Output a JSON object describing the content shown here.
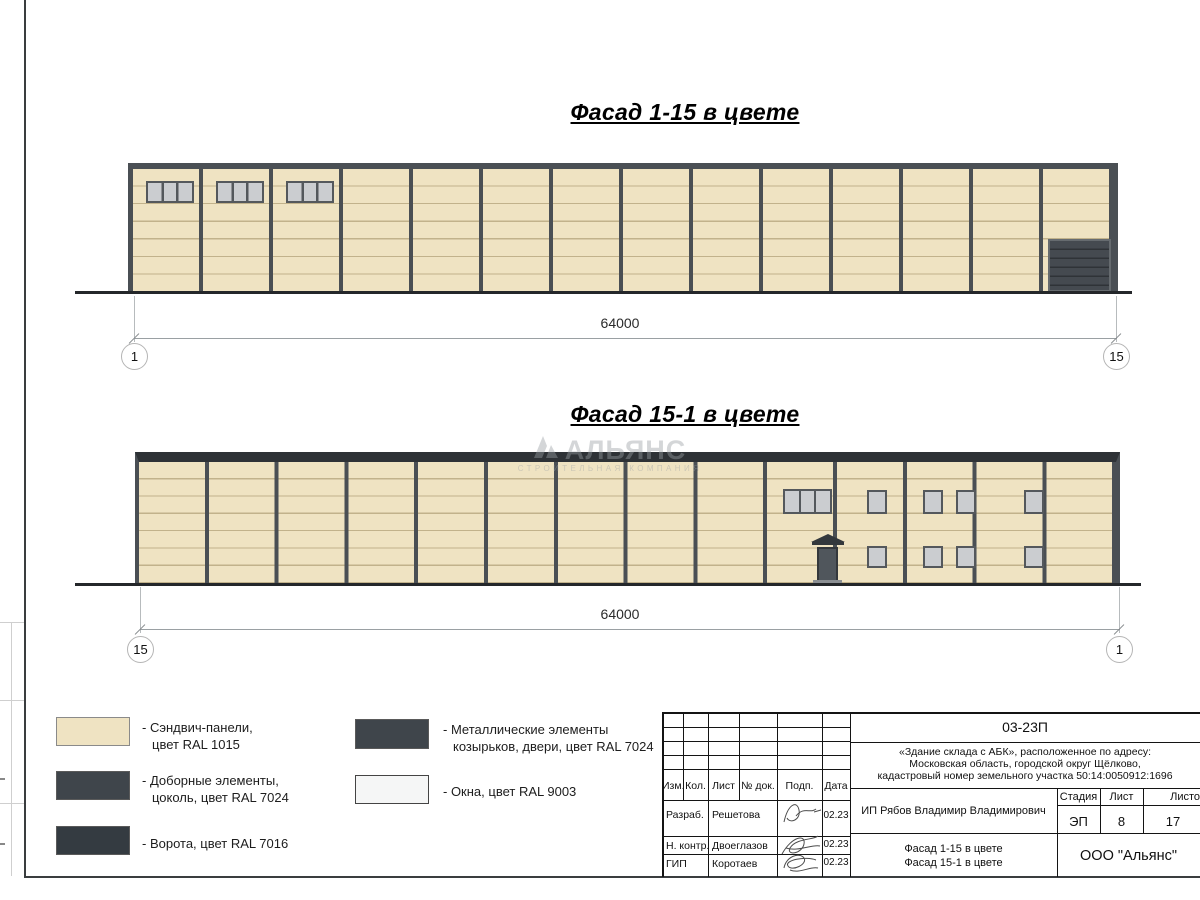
{
  "sheet": {
    "facade1": {
      "title": "Фасад 1-15 в цвете",
      "dim_total": "64000",
      "axis_left": "1",
      "axis_right": "15"
    },
    "facade2": {
      "title": "Фасад 15-1 в цвете",
      "dim_total": "64000",
      "axis_left": "15",
      "axis_right": "1"
    }
  },
  "watermark": {
    "brand": "АЛЬЯНС",
    "tagline": "СТРОИТЕЛЬНАЯ КОМПАНИЯ"
  },
  "legend": {
    "items": [
      {
        "swatch": "ral1015",
        "line1": "- Сэндвич-панели,",
        "line2": "цвет RAL 1015"
      },
      {
        "swatch": "ral7024",
        "line1": "- Доборные элементы,",
        "line2": "цоколь, цвет RAL 7024"
      },
      {
        "swatch": "ral7016",
        "line1": "- Ворота, цвет RAL 7016",
        "line2": ""
      },
      {
        "swatch": "ral7024",
        "line1": "- Металлические элементы",
        "line2": "козырьков, двери, цвет RAL 7024"
      },
      {
        "swatch": "ral9003",
        "line1": "- Окна, цвет RAL 9003",
        "line2": ""
      }
    ]
  },
  "colors": {
    "ral1015": "#efe3c2",
    "ral7024": "#3f454b",
    "ral7016": "#343b41",
    "ral9003": "#f5f6f6",
    "frame_dark": "#4a4f54"
  },
  "titleblock": {
    "doc_code": "03-23П",
    "project_line1": "«Здание склада с АБК», расположенное по адресу:",
    "project_line2": "Московская область, городской округ Щёлково,",
    "project_line3": "кадастровый номер земельного участка 50:14:0050912:1696",
    "col_izm": "Изм.",
    "col_kol": "Кол.",
    "col_list": "Лист",
    "col_doc": "№ док.",
    "col_podp": "Подп.",
    "col_data": "Дата",
    "row1_role": "Разраб.",
    "row1_name": "Решетова",
    "row1_date": "02.23",
    "row2_role": "Н. контр.",
    "row2_name": "Двоеглазов",
    "row2_date": "02.23",
    "row3_role": "ГИП",
    "row3_name": "Коротаев",
    "row3_date": "02.23",
    "client": "ИП Рябов Владимир Владимирович",
    "stage_label": "Стадия",
    "sheet_label": "Лист",
    "total_label": "Листов",
    "stage": "ЭП",
    "sheet_no": "8",
    "sheet_total": "17",
    "sheet_name_line1": "Фасад 1-15 в цвете",
    "sheet_name_line2": "Фасад 15-1 в цвете",
    "company": "ООО \"Альянс\""
  }
}
